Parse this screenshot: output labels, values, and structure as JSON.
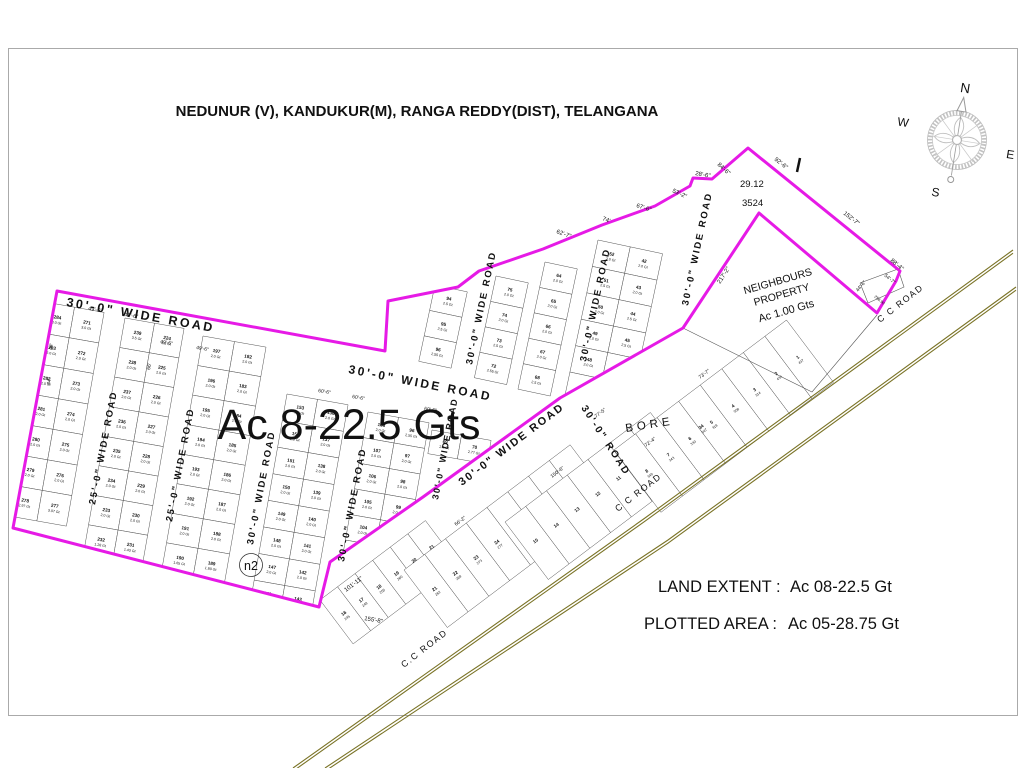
{
  "title": "NEDUNUR (V), KANDUKUR(M), RANGA REDDY(DIST), TELANGANA",
  "overlay": {
    "total_area": "Ac 8-22.5 Gts",
    "survey_a": "29.12",
    "survey_b": "3524",
    "marker_n2": "n2",
    "bore": "BORE"
  },
  "legend": {
    "land_extent_label": "LAND EXTENT :",
    "land_extent_value": "Ac 08-22.5 Gt",
    "plotted_area_label": "PLOTTED AREA :",
    "plotted_area_value": "Ac 05-28.75 Gt"
  },
  "neighbours": {
    "line1": "NEIGHBOURS",
    "line2": "PROPERTY",
    "line3": "Ac 1.00 Gts"
  },
  "compass": {
    "north": "N",
    "east": "E",
    "south": "S",
    "west": "W"
  },
  "colors": {
    "boundary": "#E61AE6",
    "road": "#7A7326",
    "plot_number": "#C0504D",
    "grid_line": "#4D4D4D",
    "dim_text": "#333333",
    "north_letter": "#C0504D",
    "compass_gray": "#B5B5B5"
  },
  "boundary": {
    "outer_points": [
      [
        57,
        291
      ],
      [
        385,
        351
      ],
      [
        388,
        301
      ],
      [
        458,
        287
      ],
      [
        479,
        271
      ],
      [
        543,
        249
      ],
      [
        602,
        225
      ],
      [
        655,
        206
      ],
      [
        690,
        186
      ],
      [
        693,
        178
      ],
      [
        712,
        179
      ],
      [
        748,
        148
      ],
      [
        900,
        271
      ],
      [
        896,
        281
      ],
      [
        877,
        313
      ],
      [
        759,
        213
      ],
      [
        683,
        328
      ],
      [
        560,
        398
      ],
      [
        423,
        497
      ],
      [
        330,
        562
      ],
      [
        319,
        607
      ],
      [
        13,
        528
      ]
    ],
    "extra_lines": [
      [
        [
          683,
          328
        ],
        [
          812,
          392
        ],
        [
          877,
          315
        ]
      ],
      [
        [
          860,
          283
        ],
        [
          898,
          269
        ],
        [
          904,
          287
        ],
        [
          868,
          303
        ],
        [
          860,
          283
        ]
      ]
    ],
    "dimensions": [
      {
        "t": "49'-6\"",
        "x": 88,
        "y": 310,
        "r": 10,
        "s": 5.5
      },
      {
        "t": "49'-6\"",
        "x": 124,
        "y": 316,
        "r": 10,
        "s": 5.5
      },
      {
        "t": "49'-6\"",
        "x": 160,
        "y": 343,
        "r": 10,
        "s": 5
      },
      {
        "t": "49'-6\"",
        "x": 196,
        "y": 349,
        "r": 10,
        "s": 5
      },
      {
        "t": "44'",
        "x": 52,
        "y": 350,
        "r": -80,
        "s": 5
      },
      {
        "t": "44'",
        "x": 50,
        "y": 385,
        "r": -80,
        "s": 5
      },
      {
        "t": "66'",
        "x": 150,
        "y": 370,
        "r": -80,
        "s": 5
      },
      {
        "t": "60'-6\"",
        "x": 318,
        "y": 392,
        "r": 10,
        "s": 5
      },
      {
        "t": "60'-6\"",
        "x": 352,
        "y": 398,
        "r": 10,
        "s": 5
      },
      {
        "t": "60'-6\"",
        "x": 424,
        "y": 410,
        "r": 10,
        "s": 5
      },
      {
        "t": "62'-7\"",
        "x": 556,
        "y": 233,
        "r": 20,
        "s": 6
      },
      {
        "t": "74'",
        "x": 602,
        "y": 220,
        "r": 22,
        "s": 6
      },
      {
        "t": "67'-6\"",
        "x": 636,
        "y": 207,
        "r": 18,
        "s": 6
      },
      {
        "t": "53'-2\"",
        "x": 672,
        "y": 192,
        "r": 25,
        "s": 6
      },
      {
        "t": "28'-6\"",
        "x": 695,
        "y": 175,
        "r": 10,
        "s": 6
      },
      {
        "t": "84'-6\"",
        "x": 717,
        "y": 165,
        "r": 42,
        "s": 6
      },
      {
        "t": "92'-6\"",
        "x": 774,
        "y": 160,
        "r": 38,
        "s": 6
      },
      {
        "t": "152'-7\"",
        "x": 843,
        "y": 214,
        "r": 38,
        "s": 6
      },
      {
        "t": "88'-4\"",
        "x": 890,
        "y": 261,
        "r": 40,
        "s": 6
      },
      {
        "t": "217'-2\"",
        "x": 720,
        "y": 284,
        "r": -57,
        "s": 6
      },
      {
        "t": "44'-6\"",
        "x": 858,
        "y": 292,
        "r": -50,
        "s": 5
      },
      {
        "t": "54'-7\"",
        "x": 884,
        "y": 276,
        "r": 40,
        "s": 5
      },
      {
        "t": "258.90",
        "x": 874,
        "y": 297,
        "r": 40,
        "s": 4
      },
      {
        "t": "101'-11\"",
        "x": 346,
        "y": 592,
        "r": -37,
        "s": 6
      },
      {
        "t": "155'-8\"",
        "x": 364,
        "y": 620,
        "r": 10,
        "s": 6
      },
      {
        "t": "77'-5\"",
        "x": 596,
        "y": 418,
        "r": -37,
        "s": 5
      },
      {
        "t": "73'-7\"",
        "x": 700,
        "y": 379,
        "r": -37,
        "s": 5
      },
      {
        "t": "66'-2\"",
        "x": 456,
        "y": 526,
        "r": -37,
        "s": 5
      },
      {
        "t": "72'-4\"",
        "x": 646,
        "y": 447,
        "r": -37,
        "s": 5
      },
      {
        "t": "150'-6\"",
        "x": 552,
        "y": 478,
        "r": -37,
        "s": 5
      }
    ]
  },
  "cc_road": {
    "labels": [
      {
        "t": "C C ROAD",
        "x": 880,
        "y": 323,
        "r": -38
      },
      {
        "t": "C C ROAD",
        "x": 618,
        "y": 512,
        "r": -38
      },
      {
        "t": "C.C ROAD",
        "x": 404,
        "y": 668,
        "r": -38
      }
    ],
    "lines": [
      [
        [
          293,
          768
        ],
        [
          645,
          518
        ],
        [
          1013,
          250
        ]
      ],
      [
        [
          325,
          768
        ],
        [
          668,
          540
        ],
        [
          1016,
          287
        ]
      ]
    ]
  },
  "road_labels": [
    {
      "t": "30'-0\" WIDE ROAD",
      "x": 66,
      "y": 306,
      "r": 10,
      "s": 12.5,
      "sp": 2.5
    },
    {
      "t": "30'-0\" WIDE ROAD",
      "x": 348,
      "y": 373,
      "r": 11,
      "s": 12,
      "sp": 2.5
    },
    {
      "t": "25'-0\" WIDE ROAD",
      "x": 95,
      "y": 505,
      "r": -79,
      "s": 9.5,
      "sp": 2
    },
    {
      "t": "25'-0\" WIDE ROAD",
      "x": 172,
      "y": 522,
      "r": -79,
      "s": 9.5,
      "sp": 2
    },
    {
      "t": "30'-0\" WIDE ROAD",
      "x": 253,
      "y": 545,
      "r": -79,
      "s": 9.5,
      "sp": 2
    },
    {
      "t": "30'-0\" WIDE ROAD",
      "x": 344,
      "y": 562,
      "r": -79,
      "s": 9.5,
      "sp": 2
    },
    {
      "t": "30'-0\" WIDE ROAD",
      "x": 438,
      "y": 500,
      "r": -79,
      "s": 9,
      "sp": 1.5
    },
    {
      "t": "30'-0\" WIDE ROAD",
      "x": 472,
      "y": 365,
      "r": -78,
      "s": 9.5,
      "sp": 2
    },
    {
      "t": "30'-0\" WIDE ROAD",
      "x": 586,
      "y": 362,
      "r": -78,
      "s": 9.5,
      "sp": 2
    },
    {
      "t": "30'-0\" WIDE ROAD",
      "x": 688,
      "y": 306,
      "r": -78,
      "s": 9.5,
      "sp": 2
    },
    {
      "t": "30'-0\" WIDE ROAD",
      "x": 462,
      "y": 486,
      "r": -37,
      "s": 11,
      "sp": 2
    },
    {
      "t": "30'-0\" ROAD",
      "x": 581,
      "y": 408,
      "r": 57,
      "s": 10,
      "sp": 2
    }
  ],
  "blocks": [
    {
      "name": "block-271",
      "x": 45,
      "y": 302,
      "rot": 10,
      "w": 30,
      "h": 31,
      "clip": true,
      "cols": [
        {
          "nums": [
            284,
            283,
            282,
            281,
            280,
            279,
            278
          ],
          "areas": [
            "3.0 Gt",
            "2.0 Gt",
            "2.0 Gt",
            "2.0 Gt",
            "2.0 Gt",
            "2.0 Gt",
            "2.97 Gt"
          ]
        },
        {
          "nums": [
            271,
            272,
            273,
            274,
            275,
            276,
            277
          ],
          "areas": [
            "3.0 Gt",
            "2.0 Gt",
            "2.0 Gt",
            "2.0 Gt",
            "2.0 Gt",
            "2.0 Gt",
            "3.07 Gt"
          ]
        }
      ]
    },
    {
      "name": "block-224",
      "x": 125,
      "y": 318,
      "rot": 10,
      "w": 30,
      "h": 30,
      "clip": true,
      "cols": [
        {
          "nums": [
            239,
            238,
            237,
            236,
            235,
            234,
            233,
            232
          ],
          "areas": [
            "3.5 Gt",
            "2.0 Gt",
            "2.0 Gt",
            "2.0 Gt",
            "2.0 Gt",
            "2.0 Gt",
            "2.0 Gt",
            "1.28 Gt"
          ]
        },
        {
          "nums": [
            224,
            225,
            226,
            227,
            228,
            229,
            230,
            231
          ],
          "areas": [
            "3.5 Gt",
            "2.0 Gt",
            "2.0 Gt",
            "2.0 Gt",
            "2.0 Gt",
            "2.0 Gt",
            "2.0 Gt",
            "1.43 Gt"
          ]
        }
      ]
    },
    {
      "name": "block-182",
      "x": 203,
      "y": 336,
      "rot": 10,
      "w": 32,
      "h": 30,
      "clip": true,
      "cols": [
        {
          "nums": [
            197,
            196,
            195,
            194,
            193,
            192,
            191,
            190
          ],
          "areas": [
            "2.0 Gt",
            "2.0 Gt",
            "2.0 Gt",
            "2.0 Gt",
            "2.0 Gt",
            "2.0 Gt",
            "2.0 Gt",
            "1.65 Gt"
          ]
        },
        {
          "nums": [
            182,
            183,
            184,
            185,
            186,
            187,
            188,
            189
          ],
          "areas": [
            "2.0 Gt",
            "2.0 Gt",
            "2.0 Gt",
            "2.0 Gt",
            "2.0 Gt",
            "2.0 Gt",
            "2.0 Gt",
            "1.80 Gt"
          ]
        }
      ]
    },
    {
      "name": "block-136",
      "x": 287,
      "y": 394,
      "rot": 10,
      "w": 31,
      "h": 27,
      "clip": true,
      "cols": [
        {
          "nums": [
            153,
            152,
            151,
            150,
            149,
            148,
            147,
            146,
            145
          ],
          "areas": [
            "2.0 Gt",
            "2.0 Gt",
            "2.0 Gt",
            "2.0 Gt",
            "2.0 Gt",
            "2.0 Gt",
            "2.0 Gt",
            "2.0 Gt",
            "1.45 Gt"
          ]
        },
        {
          "nums": [
            136,
            137,
            138,
            139,
            140,
            141,
            142,
            143,
            144
          ],
          "areas": [
            "2.0 Gt",
            "2.0 Gt",
            "2.0 Gt",
            "2.0 Gt",
            "2.0 Gt",
            "2.0 Gt",
            "2.0 Gt",
            "2.0 Gt",
            "2.09 Gt"
          ]
        }
      ]
    },
    {
      "name": "block-97",
      "x": 368,
      "y": 412,
      "rot": 10,
      "w": 31,
      "h": 26,
      "clip": true,
      "cols": [
        {
          "nums": [
            108,
            107,
            106,
            105,
            104,
            103,
            102,
            101
          ],
          "areas": [
            "2.0 Gt",
            "2.0 Gt",
            "2.0 Gt",
            "2.0 Gt",
            "2.0 Gt",
            "2.0 Gt",
            "4.04 Gt",
            "2.0 Gt"
          ]
        },
        {
          "nums": [
            96,
            97,
            98,
            99,
            100,
            111,
            112,
            113
          ],
          "areas": [
            "2.55 Gt",
            "2.0 Gt",
            "2.0 Gt",
            "2.0 Gt",
            "2.0 Gt",
            "2.0 Gt",
            "2.0 Gt",
            "2.0 Gt"
          ]
        }
      ]
    },
    {
      "name": "block-69",
      "x": 432,
      "y": 430,
      "rot": 10,
      "w": 30,
      "h": 24,
      "clip": true,
      "cols": [
        {
          "nums": [
            69
          ],
          "areas": [
            "2.0 Gt"
          ]
        },
        {
          "nums": [
            70
          ],
          "areas": [
            "2.77 Gt"
          ]
        }
      ]
    },
    {
      "name": "strip-94",
      "x": 435,
      "y": 285,
      "rot": 12,
      "w": 33,
      "h": 26,
      "clip": true,
      "cols": [
        {
          "nums": [
            94,
            95,
            96
          ],
          "areas": [
            "2.5 Gt",
            "2.5 Gt",
            "2.55 Gt"
          ]
        }
      ]
    },
    {
      "name": "strip-72",
      "x": 496,
      "y": 276,
      "rot": 12,
      "w": 33,
      "h": 26,
      "clip": true,
      "cols": [
        {
          "nums": [
            75,
            74,
            73,
            72
          ],
          "areas": [
            "2.0 Gt",
            "2.0 Gt",
            "2.5 Gt",
            "2.55 Gt"
          ]
        }
      ]
    },
    {
      "name": "strip-64",
      "x": 545,
      "y": 262,
      "rot": 12,
      "w": 33,
      "h": 26,
      "clip": true,
      "cols": [
        {
          "nums": [
            64,
            65,
            66,
            67,
            68
          ],
          "areas": [
            "2.0 Gt",
            "2.0 Gt",
            "2.0 Gt",
            "2.0 Gt",
            "2.5 Gt"
          ]
        }
      ]
    },
    {
      "name": "block-42",
      "x": 598,
      "y": 240,
      "rot": 12,
      "w": 33,
      "h": 27,
      "clip": true,
      "cols": [
        {
          "nums": [
            52,
            51,
            50,
            49,
            48,
            47
          ],
          "areas": [
            "2.0 Gt",
            "2.5 Gt",
            "2.0 Gt",
            "2.0 Gt",
            "2.0 Gt",
            "2.6 Gt"
          ]
        },
        {
          "nums": [
            42,
            43,
            44,
            45,
            46
          ],
          "areas": [
            "2.0 Gt",
            "2.0 Gt",
            "2.5 Gt",
            "2.5 Gt",
            "3.86 Gt"
          ]
        }
      ]
    }
  ],
  "strips": [
    {
      "name": "strip-16",
      "x": 320,
      "y": 600,
      "rot": -37,
      "w": 22,
      "h": 55,
      "cells": [
        16,
        17,
        18,
        19,
        20,
        21
      ],
      "subs": [
        245,
        249,
        255,
        260,
        265,
        270
      ]
    },
    {
      "name": "strip-21",
      "x": 404,
      "y": 570,
      "rot": -37,
      "w": 26,
      "h": 72,
      "cells": [
        21,
        22,
        23,
        24,
        25,
        26,
        27,
        28
      ],
      "subs": [
        262,
        269,
        273,
        277,
        283,
        290,
        296,
        302
      ]
    },
    {
      "name": "strip-9",
      "x": 505,
      "y": 522,
      "rot": -37,
      "w": 26,
      "h": 72,
      "cells": [
        15,
        14,
        13,
        12,
        11,
        10,
        9
      ],
      "subs": []
    },
    {
      "name": "strip-1",
      "x": 614,
      "y": 450,
      "rot": -37,
      "w": 27,
      "h": 78,
      "cells": [
        8,
        7,
        6,
        5,
        4,
        3,
        2,
        1
      ],
      "subs": [
        349,
        343,
        330,
        318,
        308,
        314,
        434,
        437
      ]
    }
  ],
  "loose_plots": [
    {
      "n": "34",
      "a": "547",
      "x": 702,
      "y": 428,
      "r": -37
    }
  ]
}
